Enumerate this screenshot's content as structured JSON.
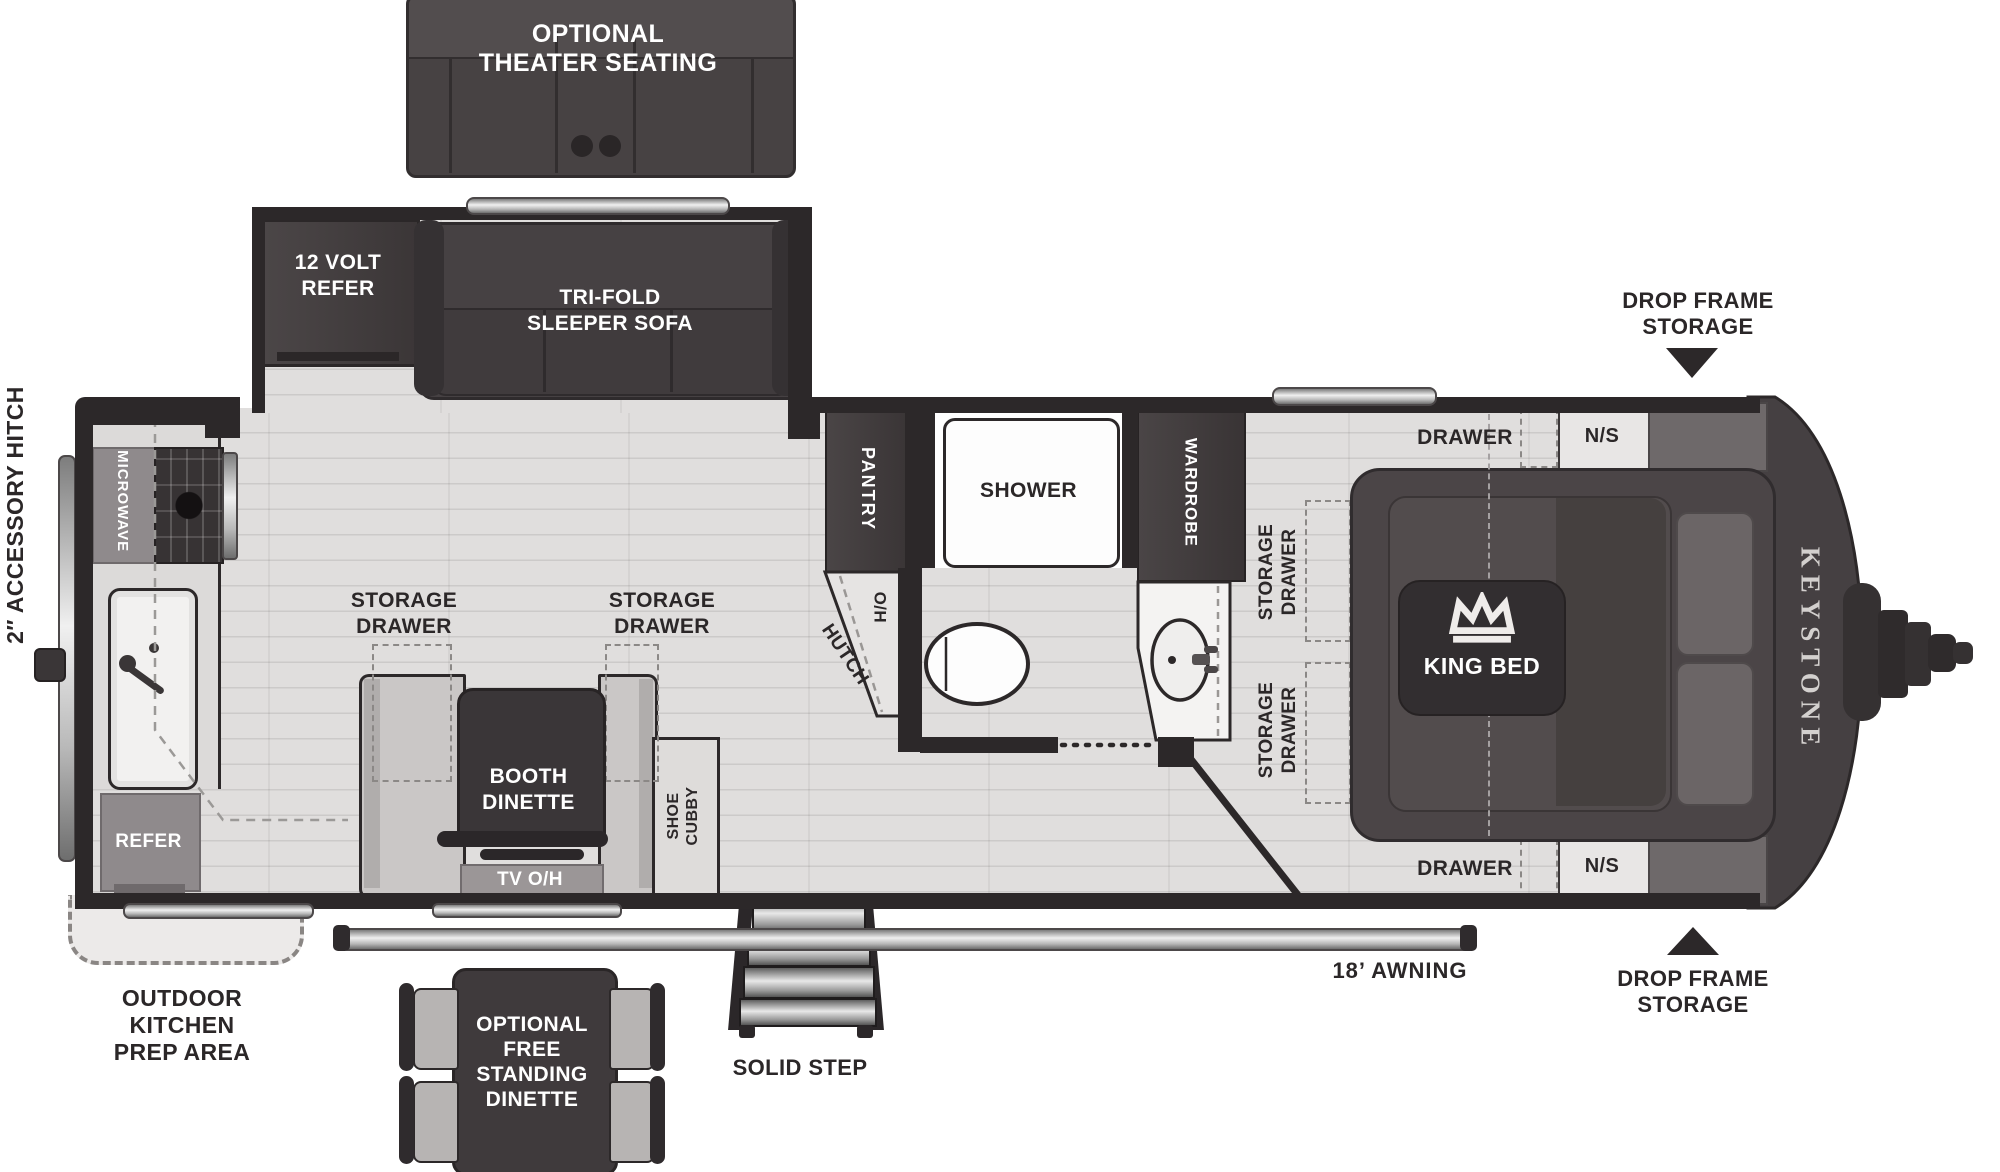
{
  "brand": "KEYSTONE",
  "slideouts": {
    "theater": "OPTIONAL\nTHEATER SEATING",
    "refer12v": "12 VOLT\nREFER",
    "sofa": "TRI-FOLD\nSLEEPER SOFA"
  },
  "galley": {
    "microwave": "MICROWAVE",
    "refer": "REFER",
    "storage_drawer": "STORAGE\nDRAWER"
  },
  "dinette": {
    "booth": "BOOTH\nDINETTE",
    "tv": "TV O/H",
    "shoe_cubby": "SHOE\nCUBBY",
    "free_standing": "OPTIONAL\nFREE\nSTANDING\nDINETTE"
  },
  "bath": {
    "pantry": "PANTRY",
    "hutch": "HUTCH",
    "overhead": "O/H",
    "shower": "SHOWER",
    "wardrobe": "WARDROBE"
  },
  "bedroom": {
    "king_bed": "KING BED",
    "drawer": "DRAWER",
    "nightstand": "N/S",
    "storage_drawer": "STORAGE\nDRAWER"
  },
  "exterior": {
    "drop_frame": "DROP FRAME\nSTORAGE",
    "awning": "18’ AWNING",
    "solid_step": "SOLID STEP",
    "outdoor_kitchen": "OUTDOOR\nKITCHEN\nPREP AREA",
    "hitch": "2″ ACCESSORY HITCH"
  }
}
